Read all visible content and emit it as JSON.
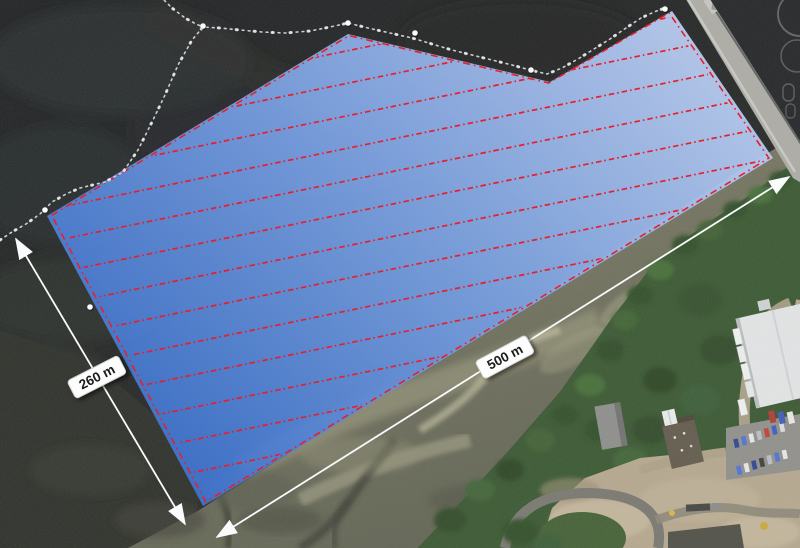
{
  "survey_area": {
    "vertices": [
      [
        47,
        216
      ],
      [
        348,
        34
      ],
      [
        550,
        82
      ],
      [
        672,
        11
      ],
      [
        773,
        158
      ],
      [
        203,
        506
      ]
    ],
    "fill_top_color": "#bed1f6",
    "fill_mid_color": "#7ba2e4",
    "fill_bottom_color": "#3f74d0",
    "fill_opacity": 0.93,
    "outline_color": "#e6202e",
    "outline_dash": "7 4 1.6 4",
    "transects": {
      "color": "#e81e2c",
      "slope": -0.205,
      "first_intercept": 122,
      "intercept_spacing": 32.5,
      "count": 14,
      "dash": "5.5 3 1.6 3"
    }
  },
  "measurements": [
    {
      "label": "260 m",
      "x1": 16,
      "y1": 239,
      "x2": 185,
      "y2": 524,
      "label_x": 97,
      "label_y": 377,
      "label_rotation": -27
    },
    {
      "label": "500 m",
      "x1": 217,
      "y1": 537,
      "x2": 789,
      "y2": 177,
      "label_x": 505,
      "label_y": 357,
      "label_rotation": -28
    }
  ],
  "dimension_style": {
    "line_color": "#fafbfc"
  },
  "boom_line": {
    "color": "#c9ced3",
    "main_points": [
      [
        0,
        240
      ],
      [
        12,
        232
      ],
      [
        26,
        224
      ],
      [
        40,
        214
      ],
      [
        52,
        202
      ],
      [
        66,
        194
      ],
      [
        80,
        188
      ],
      [
        105,
        182
      ],
      [
        123,
        172
      ],
      [
        138,
        150
      ],
      [
        152,
        122
      ],
      [
        165,
        95
      ],
      [
        178,
        65
      ],
      [
        192,
        40
      ],
      [
        203,
        27
      ],
      [
        220,
        28
      ],
      [
        240,
        30
      ],
      [
        262,
        32
      ],
      [
        285,
        33
      ],
      [
        310,
        31
      ],
      [
        330,
        27
      ],
      [
        348,
        23
      ],
      [
        368,
        28
      ],
      [
        390,
        33
      ],
      [
        412,
        38
      ],
      [
        432,
        44
      ],
      [
        452,
        50
      ],
      [
        472,
        55
      ],
      [
        492,
        60
      ],
      [
        512,
        65
      ],
      [
        530,
        70
      ],
      [
        547,
        74
      ],
      [
        562,
        68
      ],
      [
        578,
        59
      ],
      [
        594,
        49
      ],
      [
        610,
        39
      ],
      [
        626,
        28
      ],
      [
        641,
        18
      ],
      [
        654,
        12
      ],
      [
        665,
        8
      ]
    ],
    "branch_points": [
      [
        160,
        -4
      ],
      [
        172,
        8
      ],
      [
        185,
        18
      ],
      [
        196,
        24
      ],
      [
        203,
        27
      ]
    ],
    "buoys": [
      [
        45,
        210
      ],
      [
        203,
        26
      ],
      [
        348,
        23
      ],
      [
        415,
        33
      ],
      [
        531,
        70
      ],
      [
        665,
        9
      ],
      [
        90,
        307
      ]
    ]
  }
}
